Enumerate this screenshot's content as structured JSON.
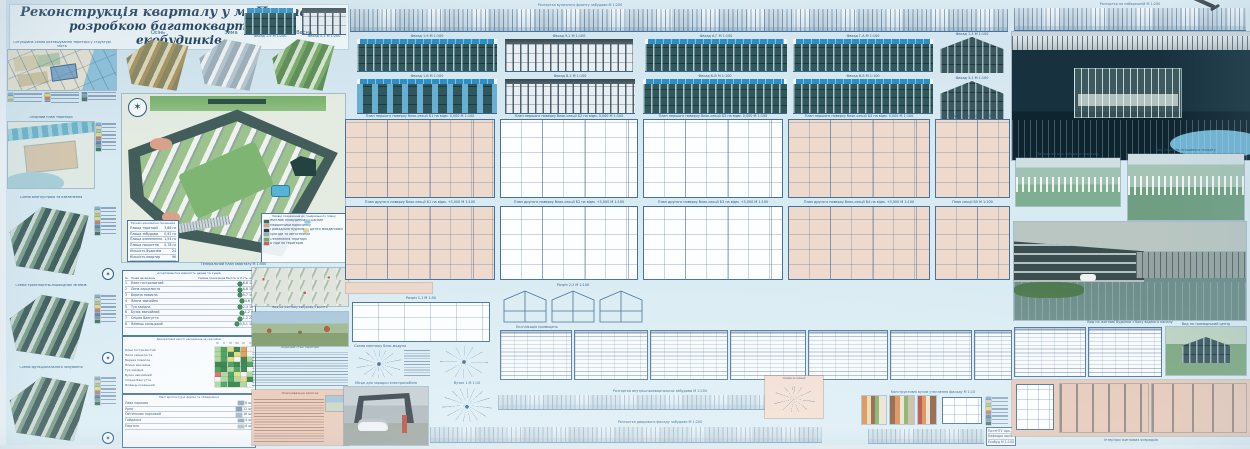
{
  "palette": {
    "paper": "#d7e9f2",
    "ink": "#2a5a85",
    "teal_facade": "#30575c",
    "pv_blue": "#2e8ec6",
    "salmon": "#ecd7ca",
    "plan_line": "#46719c",
    "master_green": "#9cc28e",
    "night": "#132c38",
    "pond": "#6fb3d2"
  },
  "title": {
    "line1": "Реконструкція кварталу у м. Полтава з",
    "line2": "розробкою багатоквартирних",
    "line3": "екобудинків"
  },
  "seasons": {
    "s1": "Осінь",
    "s2": "Зима",
    "s3": "Весна"
  },
  "left_maps": {
    "m1": {
      "caption": "Ситуаційна схема розташування території у структурі міста",
      "legend_title": "Умовні позначення"
    },
    "m2": {
      "caption": "Опорний план території",
      "legend_title": "Умовні позначення"
    },
    "m3": {
      "caption": "Схема благоустрою та озеленення",
      "legend_title": "Умовні позначення"
    },
    "m4": {
      "caption": "Схема транспортно-пішохідних зв'язків",
      "legend_title": "Умовні позначення"
    },
    "m5": {
      "caption": "Схема функціонального зонування",
      "legend_title": "Умовні позначення"
    },
    "legend_colors": [
      "#7fb3d0",
      "#d8cfae",
      "#a9c896",
      "#e3d878",
      "#c87f6f",
      "#5f8fb5",
      "#8a9ba8",
      "#3f7f5f"
    ]
  },
  "masterplan": {
    "caption": "Генеральний план кварталу М 1:500",
    "legend_title": "Умовні позначення до генерального плану",
    "legend_items": [
      {
        "c": "#3f6f52",
        "l": "Житлові екобудинки"
      },
      {
        "c": "#8fd0e8",
        "l": "Басейн"
      },
      {
        "c": "#d9a08a",
        "l": "Майданчики відпочинку"
      },
      {
        "c": "#24423f",
        "l": "Громадська будівля"
      },
      {
        "c": "#e3d878",
        "l": "Дитячі майданчики"
      },
      {
        "c": "#9aa8b2",
        "l": "Проїзди та автостоянки"
      },
      {
        "c": "#6fae5f",
        "l": "Озеленення території"
      },
      {
        "c": "#cf5f4f",
        "l": "В'їзди на територію"
      }
    ],
    "tep": {
      "title": "Техніко-економічні показники",
      "rows": [
        [
          "Площа території",
          "3,86 га"
        ],
        [
          "Площа забудови",
          "0,92 га"
        ],
        [
          "Площа озеленення",
          "1,54 га"
        ],
        [
          "Площа покриттів",
          "0,78 га"
        ],
        [
          "Кількість будинків",
          "24"
        ],
        [
          "Кількість квартир",
          "96"
        ],
        [
          "Щільність забудови",
          "24 %"
        ]
      ]
    }
  },
  "plants": {
    "title": "Асортиментна відомість дерев та кущів",
    "headers": [
      "№",
      "Назва насаджень",
      "Умовне позначення",
      "Висота, м",
      "К-сть, шт"
    ],
    "rows": [
      [
        "1",
        "Клен гостролистий",
        "6-8",
        "12"
      ],
      [
        "2",
        "Липа серцелиста",
        "6-8",
        "14"
      ],
      [
        "3",
        "Береза повисла",
        "5-7",
        "10"
      ],
      [
        "4",
        "Ялина звичайна",
        "4-6",
        "8"
      ],
      [
        "5",
        "Туя західна",
        "2-3",
        "16"
      ],
      [
        "6",
        "Бузок звичайний",
        "1-2",
        "9"
      ],
      [
        "7",
        "Спірея Вангутта",
        "1-2",
        "22"
      ],
      [
        "8",
        "Ялівець козацький",
        "0,5-1",
        "18"
      ]
    ]
  },
  "matrix": {
    "title": "Декоративні якості насаджень за сезонами",
    "cols": [
      "IV",
      "V",
      "VI",
      "VII",
      "IX",
      "X"
    ],
    "palette": {
      "G": "#3f9e54",
      "g": "#a8d59a",
      "Y": "#e3d878",
      "R": "#d96a5a",
      "W": "#eef2f2",
      "D": "#2e7d44",
      "O": "#de9a4e"
    },
    "rows": [
      {
        "n": "Клен гостролистий",
        "c": "gGYDOW"
      },
      {
        "n": "Липа серцелиста",
        "c": "gGDYOW"
      },
      {
        "n": "Береза повисла",
        "c": "gGYWDg"
      },
      {
        "n": "Ялина звичайна",
        "c": "DDGDDG"
      },
      {
        "n": "Туя західна",
        "c": "GDgGDW"
      },
      {
        "n": "Бузок звичайний",
        "c": "RgGYWg"
      },
      {
        "n": "Спірея Вангутта",
        "c": "WgGgYD"
      },
      {
        "n": "Ялівець козацький",
        "c": "gGDDgW"
      }
    ]
  },
  "equipment": {
    "title": "Малі архітектурні форми та обладнання",
    "rows": [
      [
        "Лава паркова",
        "#8da6b5",
        "8 шт"
      ],
      [
        "Урна",
        "#7f98a8",
        "12 шт"
      ],
      [
        "Світильник парковий",
        "#9db3c2",
        "16 шт"
      ],
      [
        "Гойдалка",
        "#8da6b5",
        "4 шт"
      ],
      [
        "Пергола",
        "#a8bcc8",
        "6 шт"
      ]
    ]
  },
  "notes": {
    "photo1_caption": "Вид на житлову забудову з висоти",
    "photo2_caption": "Існуючий стан території",
    "salmon_note_title": "Пояснювальна записка"
  },
  "center": {
    "top_strip_caption": "Розгортка вуличного фронту забудови М 1:200",
    "mini_f1": "Фасад 1-5 М 1:200",
    "mini_f2": "Фасад 5-1 М 1:200",
    "facades": {
      "f1": "Фасад 1-9 М 1:100",
      "f2": "Фасад 9-1 М 1:100",
      "f3": "Фасад А-Г М 1:100",
      "f4": "Фасад Г-А М 1:100",
      "f5": "Фасад 1-8 М 1:100",
      "f6": "Фасад 8-1 М 1:100",
      "f7": "Фасад Б-В М 1:100",
      "f8": "Фасад В-Б М 1:100",
      "g1": "Фасад 1-3 М 1:100",
      "g2": "Фасад 3-1 М 1:100"
    },
    "plans_row1": [
      "План першого поверху блок-секції Б1 на відм. 0,000 М 1:100",
      "План першого поверху блок-секції Б2 на відм. 0,000 М 1:100",
      "План першого поверху блок-секції Б3 на відм. 0,000 М 1:100",
      "План першого поверху блок-секції Б4 на відм. 0,000 М 1:100",
      "План секції Б5 М 1:100"
    ],
    "plans_row2": [
      "План другого поверху блок-секції Б1 на відм. +3,000 М 1:100",
      "План другого поверху блок-секції Б2 на відм. +3,000 М 1:100",
      "План другого поверху блок-секції Б3 на відм. +3,000 М 1:100",
      "План другого поверху блок-секції Б4 на відм. +3,000 М 1:100",
      "План секції Б5 М 1:100"
    ],
    "sec1": "Розріз 1-1 М 1:50",
    "gsec": "Розріз 2-2 М 1:100",
    "exploded": "Схема монтажу блок-модуля",
    "node": "Вузол 1 М 1:10",
    "exp_caption": "Експлікація приміщень",
    "ev_caption": "Місце для зарядки електромобілів",
    "strip1_caption": "Розгортка внутрішньоквартальної забудови М 1:200",
    "strip2_caption": "Розгортка дворового фасаду забудови М 1:200",
    "details_caption": "Конструктивні вузли утеплення фасаду М 1:10",
    "scheme_caption": "Схема інсоляції"
  },
  "right": {
    "top_strip_caption": "Розгортка по набережній М 1:200",
    "aerial1_caption": "Загальний вид забудови кварталу",
    "aerial2_caption": "Вид з висоти пташиного польоту",
    "street_caption": "Вид на житлові будинки з боку водного каналу",
    "green_caption": "Вид на громадський центр",
    "interior_caption": "Інтер'єри житлових осередків"
  },
  "stamp": {
    "rows": [
      [
        "ПолтНТУ",
        "Арк. 1"
      ],
      [
        "Кафедра архітектури",
        ""
      ],
      [
        "Екобудинки",
        "М 1:100"
      ]
    ]
  }
}
